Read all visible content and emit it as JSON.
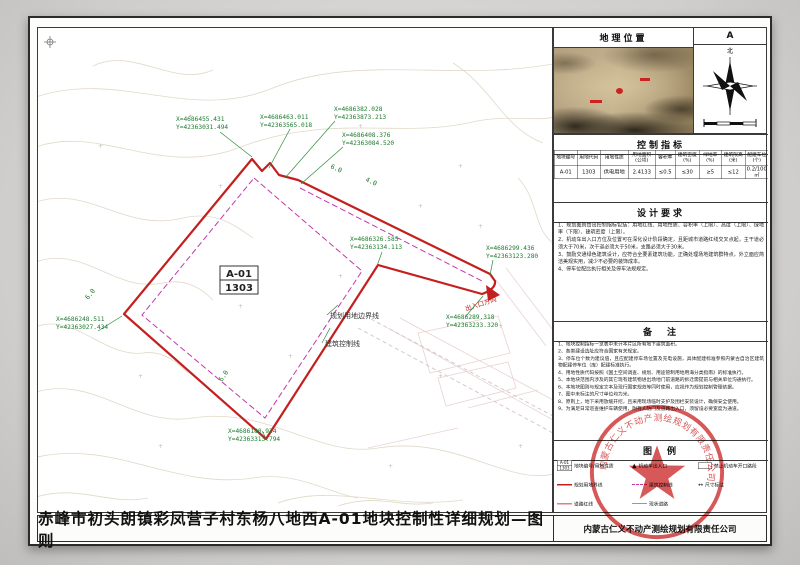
{
  "colors": {
    "boundary_red": "#c41f1f",
    "control_magenta": "#c438a8",
    "coordinate_green": "#1e7a2e",
    "stamp_red": "#cf3a3a"
  },
  "sheet": {
    "title": "赤峰市初头朗镇彩凤营子村东杨八地西A-01地块控制性详细规划—图则",
    "company": "内蒙古仁义不动产测绘规划有限责任公司"
  },
  "drawing": {
    "parcel_code": "A-01",
    "parcel_use_code": "1303",
    "boundary_label": "规划用地边界线",
    "control_line_label": "建筑控制线",
    "entrance_label": "出入口方向",
    "dims": [
      "6.0",
      "6.0",
      "6.0",
      "4.0"
    ],
    "coords": [
      {
        "x": "X=4686455.431",
        "y": "Y=42363031.494"
      },
      {
        "x": "X=4686463.011",
        "y": "Y=42363565.018"
      },
      {
        "x": "X=4686382.028",
        "y": "Y=42363873.213"
      },
      {
        "x": "X=4686408.376",
        "y": "Y=42363084.520"
      },
      {
        "x": "X=4686326.585",
        "y": "Y=42363134.113"
      },
      {
        "x": "X=4686299.436",
        "y": "Y=42363123.280"
      },
      {
        "x": "X=4686289.318",
        "y": "Y=42363233.320"
      },
      {
        "x": "X=4686248.511",
        "y": "Y=42363027.434"
      },
      {
        "x": "X=4686180.934",
        "y": "Y=42363313.794"
      }
    ]
  },
  "sidebar": {
    "location_title": "地理位置",
    "sheet_no": "A",
    "north_label": "北",
    "indicators": {
      "title": "控制指标",
      "headers": [
        "地块编号",
        "用地代码",
        "用地性质",
        "用地面积(公顷)",
        "容积率",
        "建筑密度(%)",
        "绿地率(%)",
        "建筑限高(米)",
        "配建车位(个)"
      ],
      "row": [
        "A-01",
        "1303",
        "供电用地",
        "2.4133",
        "≤0.5",
        "≤30",
        "≥5",
        "≤12",
        "0.2/100㎡"
      ]
    },
    "design": {
      "title": "设计要求",
      "items": [
        "1、规划图则给出控制指标包括：用地红线、用地性质、容积率（上限）、高度（上限）、绿地率（下限）、建筑密度（上限）。",
        "2、机动车出入口方位及位置可在深化设计阶段确定，且距城市道路红线交叉点起，主干道必须大于70米，次干道必须大于50米，支路必须大于30米。",
        "3、鼓励交通绿色建筑设计，应符合全要素建筑功能，正确处理场地建筑群特点，外立面应简洁美观实用，减少不必要的装饰成本。",
        "4、停车位配比执行相关及停车法规规定。"
      ]
    },
    "notes": {
      "title": "备　注",
      "items": [
        "1、地块控制指标一览表中未计本片区所有地下建筑面积。",
        "2、各类建设选址应符合国家有关规定。",
        "3、停车位个数为建议值，且应配建停车场位置及充电设施，具体配建标准参照内蒙古自治区建筑物配建停车位（库）配建标准执行。",
        "4、用地性质代码按照《国土空间调查、规划、用途管制用地用海分类指南》的标准执行。",
        "5、本地块范围内涉及的其它现有建筑物进出场地门前道路的拆迁需提前与相关单位沟通执行。",
        "6、本地块图则与规定文本及现行国家规范等同时使用，应视作为规划控制管理依据。",
        "7、图中未标注的尺寸单位均为米。",
        "8、原则上，地下采用放缓开挖，且采用现场临时支护及围栏安装设计，确保安全使用。",
        "9、为满足日常巡查维护车辆使用，附有人防门及道路出入口，须留设必要宽度为通道。"
      ]
    },
    "legend": {
      "title": "图　例",
      "mini_parcel_top": "A-01",
      "mini_parcel_bottom": "1303",
      "items": [
        {
          "label": "地块编号/用地性质"
        },
        {
          "label": "规划用地界线"
        },
        {
          "label": "道路红线"
        },
        {
          "label": "机动车出入口"
        },
        {
          "label": "建筑控制线"
        },
        {
          "label": "现状道路"
        },
        {
          "label": "禁止机动车开口路段"
        },
        {
          "label": "尺寸标注"
        }
      ]
    },
    "stamp_text": "内蒙古仁义不动产测绘规划有限责任公司"
  }
}
